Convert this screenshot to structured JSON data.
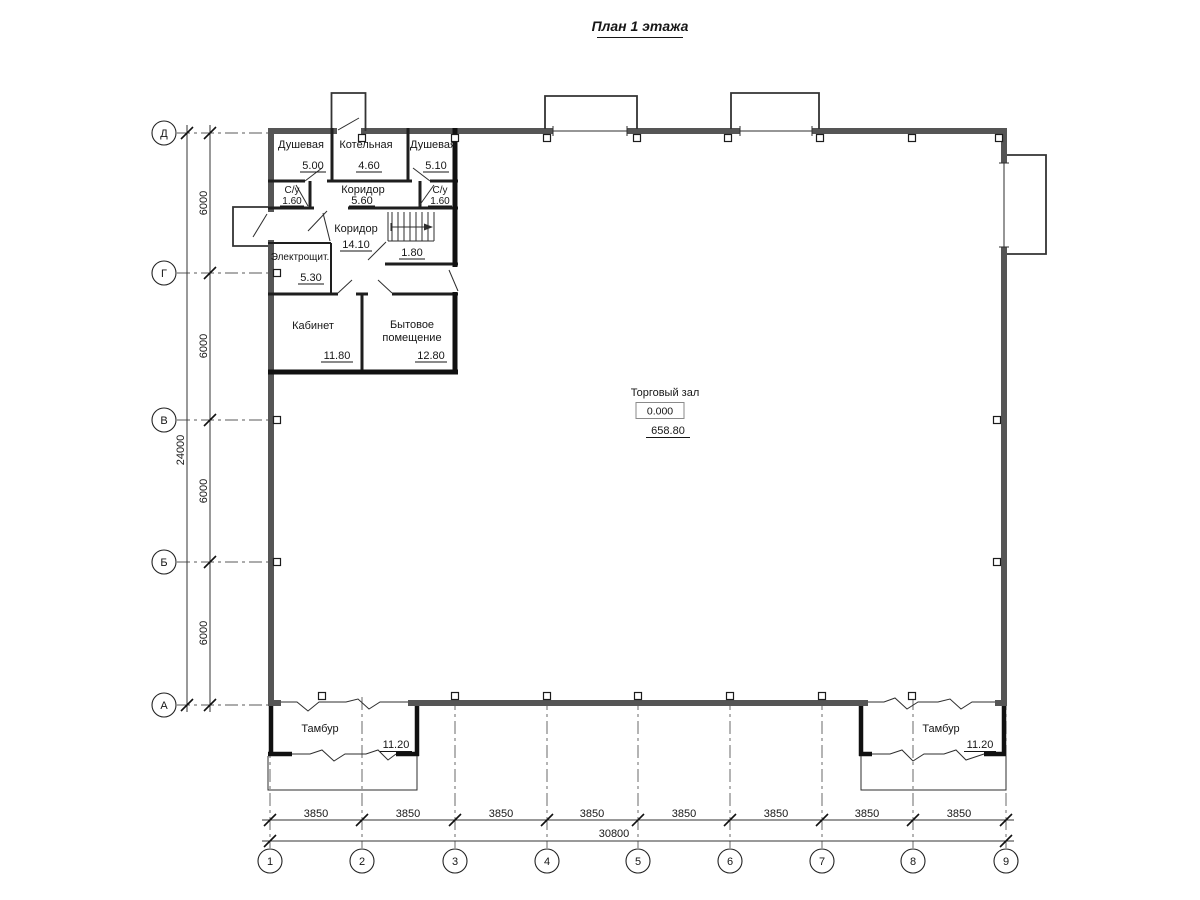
{
  "title": "План 1 этажа",
  "colors": {
    "line": "#2e2e2e",
    "wall_outer": "#555555",
    "wall_inner": "#111111",
    "background": "#ffffff"
  },
  "rooms": {
    "shower_left": {
      "name": "Душевая",
      "area": "5.00"
    },
    "boiler": {
      "name": "Котельная",
      "area": "4.60"
    },
    "shower_right": {
      "name": "Душевая",
      "area": "5.10"
    },
    "wc_left": {
      "name": "С/у",
      "area": "1.60"
    },
    "corridor_small": {
      "name": "Коридор",
      "area": "5.60"
    },
    "wc_right": {
      "name": "С/у",
      "area": "1.60"
    },
    "corridor_main": {
      "name": "Коридор",
      "area": "14.10"
    },
    "under_stairs": {
      "area": "1.80"
    },
    "electrical": {
      "name": "Электрощит.",
      "area": "5.30"
    },
    "office": {
      "name": "Кабинет",
      "area": "11.80"
    },
    "utility": {
      "name_line1": "Бытовое",
      "name_line2": "помещение",
      "area": "12.80"
    },
    "sales_hall": {
      "name": "Торговый зал",
      "elevation": "0.000",
      "area": "658.80"
    },
    "vestibule_left": {
      "name": "Тамбур",
      "area": "11.20"
    },
    "vestibule_right": {
      "name": "Тамбур",
      "area": "11.20"
    }
  },
  "axes": {
    "rows": [
      "Д",
      "Г",
      "В",
      "Б",
      "А"
    ],
    "cols": [
      "1",
      "2",
      "3",
      "4",
      "5",
      "6",
      "7",
      "8",
      "9"
    ]
  },
  "dimensions": {
    "bottom_segments": [
      "3850",
      "3850",
      "3850",
      "3850",
      "3850",
      "3850",
      "3850",
      "3850"
    ],
    "bottom_total": "30800",
    "left_segments": [
      "6000",
      "6000",
      "6000",
      "6000"
    ],
    "left_total": "24000"
  }
}
